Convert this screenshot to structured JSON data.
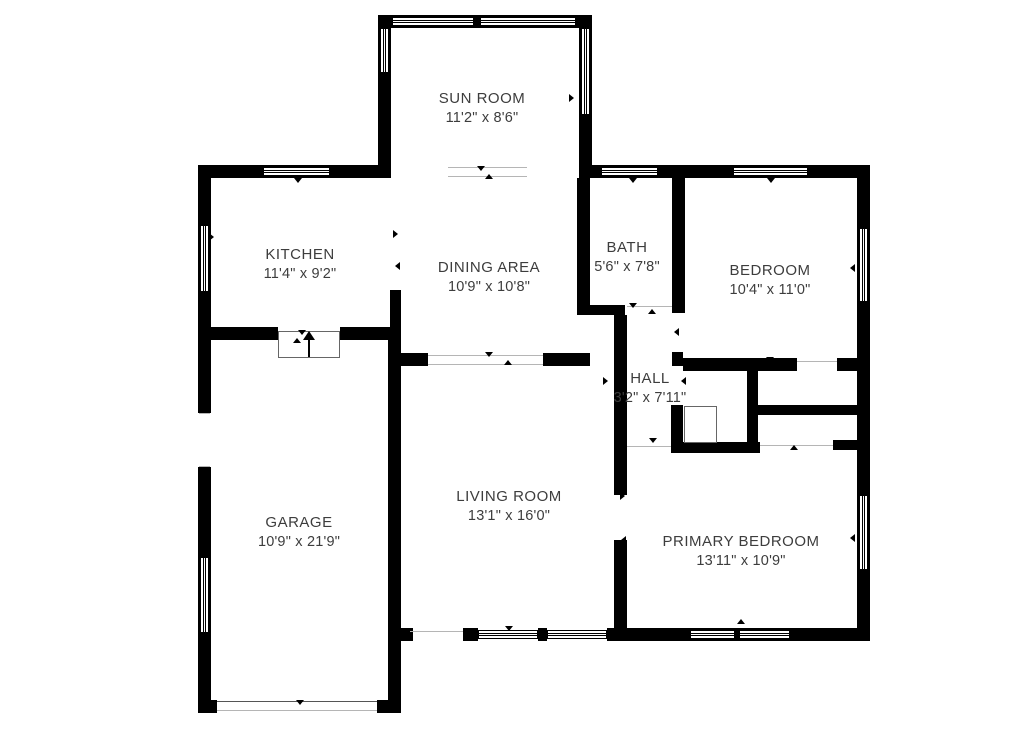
{
  "title": "Floor plan",
  "colors": {
    "wall": "#000000",
    "text": "#3d3d3d",
    "background": "#ffffff"
  },
  "rooms": [
    {
      "name": "SUN ROOM",
      "dims": "11'2\" x 8'6\""
    },
    {
      "name": "KITCHEN",
      "dims": "11'4\" x 9'2\""
    },
    {
      "name": "DINING AREA",
      "dims": "10'9\" x 10'8\""
    },
    {
      "name": "BATH",
      "dims": "5'6\" x 7'8\""
    },
    {
      "name": "BEDROOM",
      "dims": "10'4\" x 11'0\""
    },
    {
      "name": "HALL",
      "dims": "3'2\" x 7'11\""
    },
    {
      "name": "GARAGE",
      "dims": "10'9\" x 21'9\""
    },
    {
      "name": "LIVING ROOM",
      "dims": "13'1\" x 16'0\""
    },
    {
      "name": "PRIMARY BEDROOM",
      "dims": "13'11\" x 10'9\""
    }
  ]
}
